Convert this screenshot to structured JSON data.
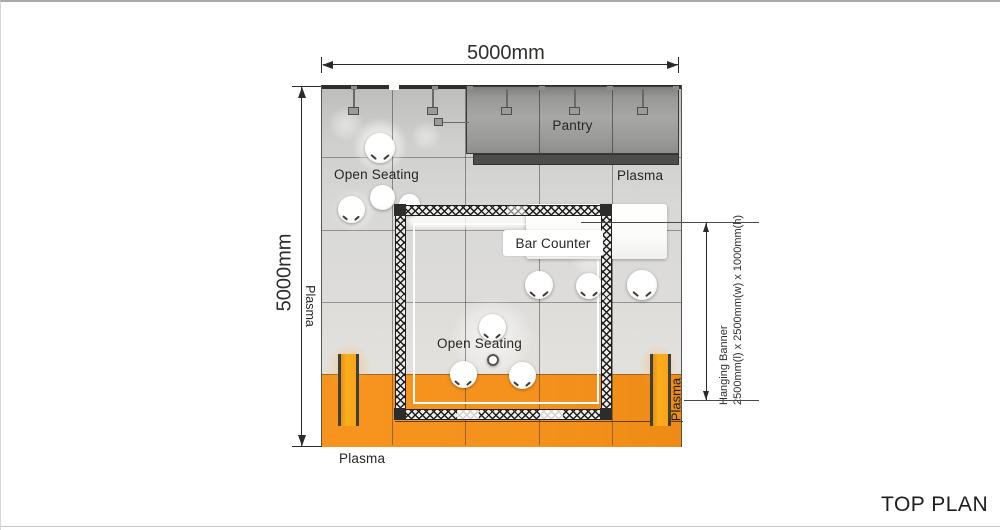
{
  "title": "TOP PLAN",
  "dimensions": {
    "width_label": "5000mm",
    "height_label": "5000mm",
    "hanging_banner": {
      "line1": "Hanging Banner",
      "line2": "2500mm(l) x 2500mm(w) x 1000mm(h)"
    }
  },
  "areas": {
    "pantry": "Pantry",
    "bar_counter": "Bar Counter",
    "open_seating_top": "Open Seating",
    "open_seating_center": "Open Seating"
  },
  "plasma": {
    "top_right": "Plasma",
    "left": "Plasma",
    "right": "Plasma",
    "bottom": "Plasma"
  },
  "colors": {
    "orange": "#F5921E",
    "plasma_yellow": "#FAA41D",
    "pantry_gray": "#9B9B99",
    "floor_gray": "#D8D8D6"
  }
}
